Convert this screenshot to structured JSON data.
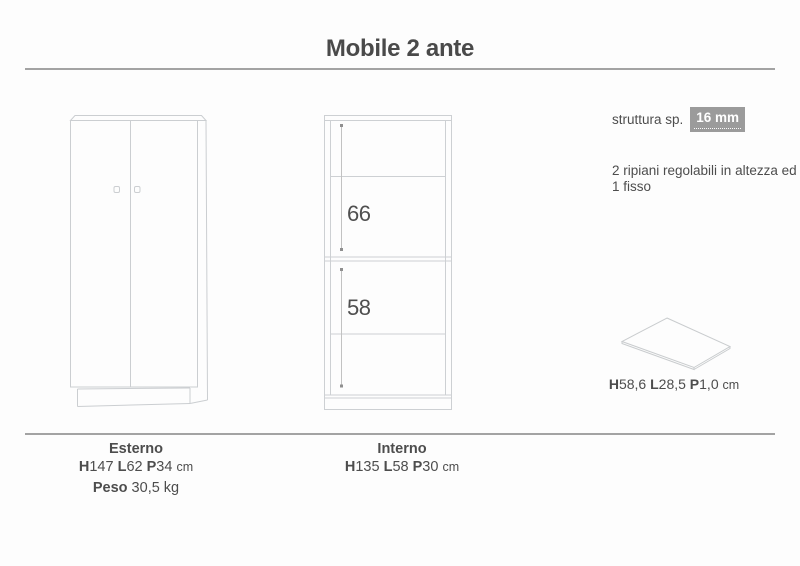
{
  "title": "Mobile 2 ante",
  "specs": {
    "struttura_label": "struttura sp.",
    "struttura_value": "16 mm",
    "ripiani_line1": "2 ripiani regolabili in altezza ed",
    "ripiani_line2": "1 fisso"
  },
  "interior_dims": {
    "upper": "66",
    "lower": "58"
  },
  "shelf_panel": {
    "h_label": "H",
    "h_value": "58,6 ",
    "l_label": "L",
    "l_value": "28,5 ",
    "p_label": "P",
    "p_value": "1,0 ",
    "unit": "cm"
  },
  "esterno": {
    "title": "Esterno",
    "h_label": "H",
    "h_value": "147 ",
    "l_label": "L",
    "l_value": "62 ",
    "p_label": "P",
    "p_value": "34 ",
    "unit": "cm",
    "peso_label": "Peso",
    "peso_value": " 30,5 kg"
  },
  "interno": {
    "title": "Interno",
    "h_label": "H",
    "h_value": "135 ",
    "l_label": "L",
    "l_value": "58 ",
    "p_label": "P",
    "p_value": "30 ",
    "unit": "cm"
  },
  "colors": {
    "text": "#4d4d4d",
    "line_art": "#cbced1",
    "rule": "#a3a3a3",
    "badge_bg": "#9b9b9b",
    "badge_text": "#ffffff"
  }
}
